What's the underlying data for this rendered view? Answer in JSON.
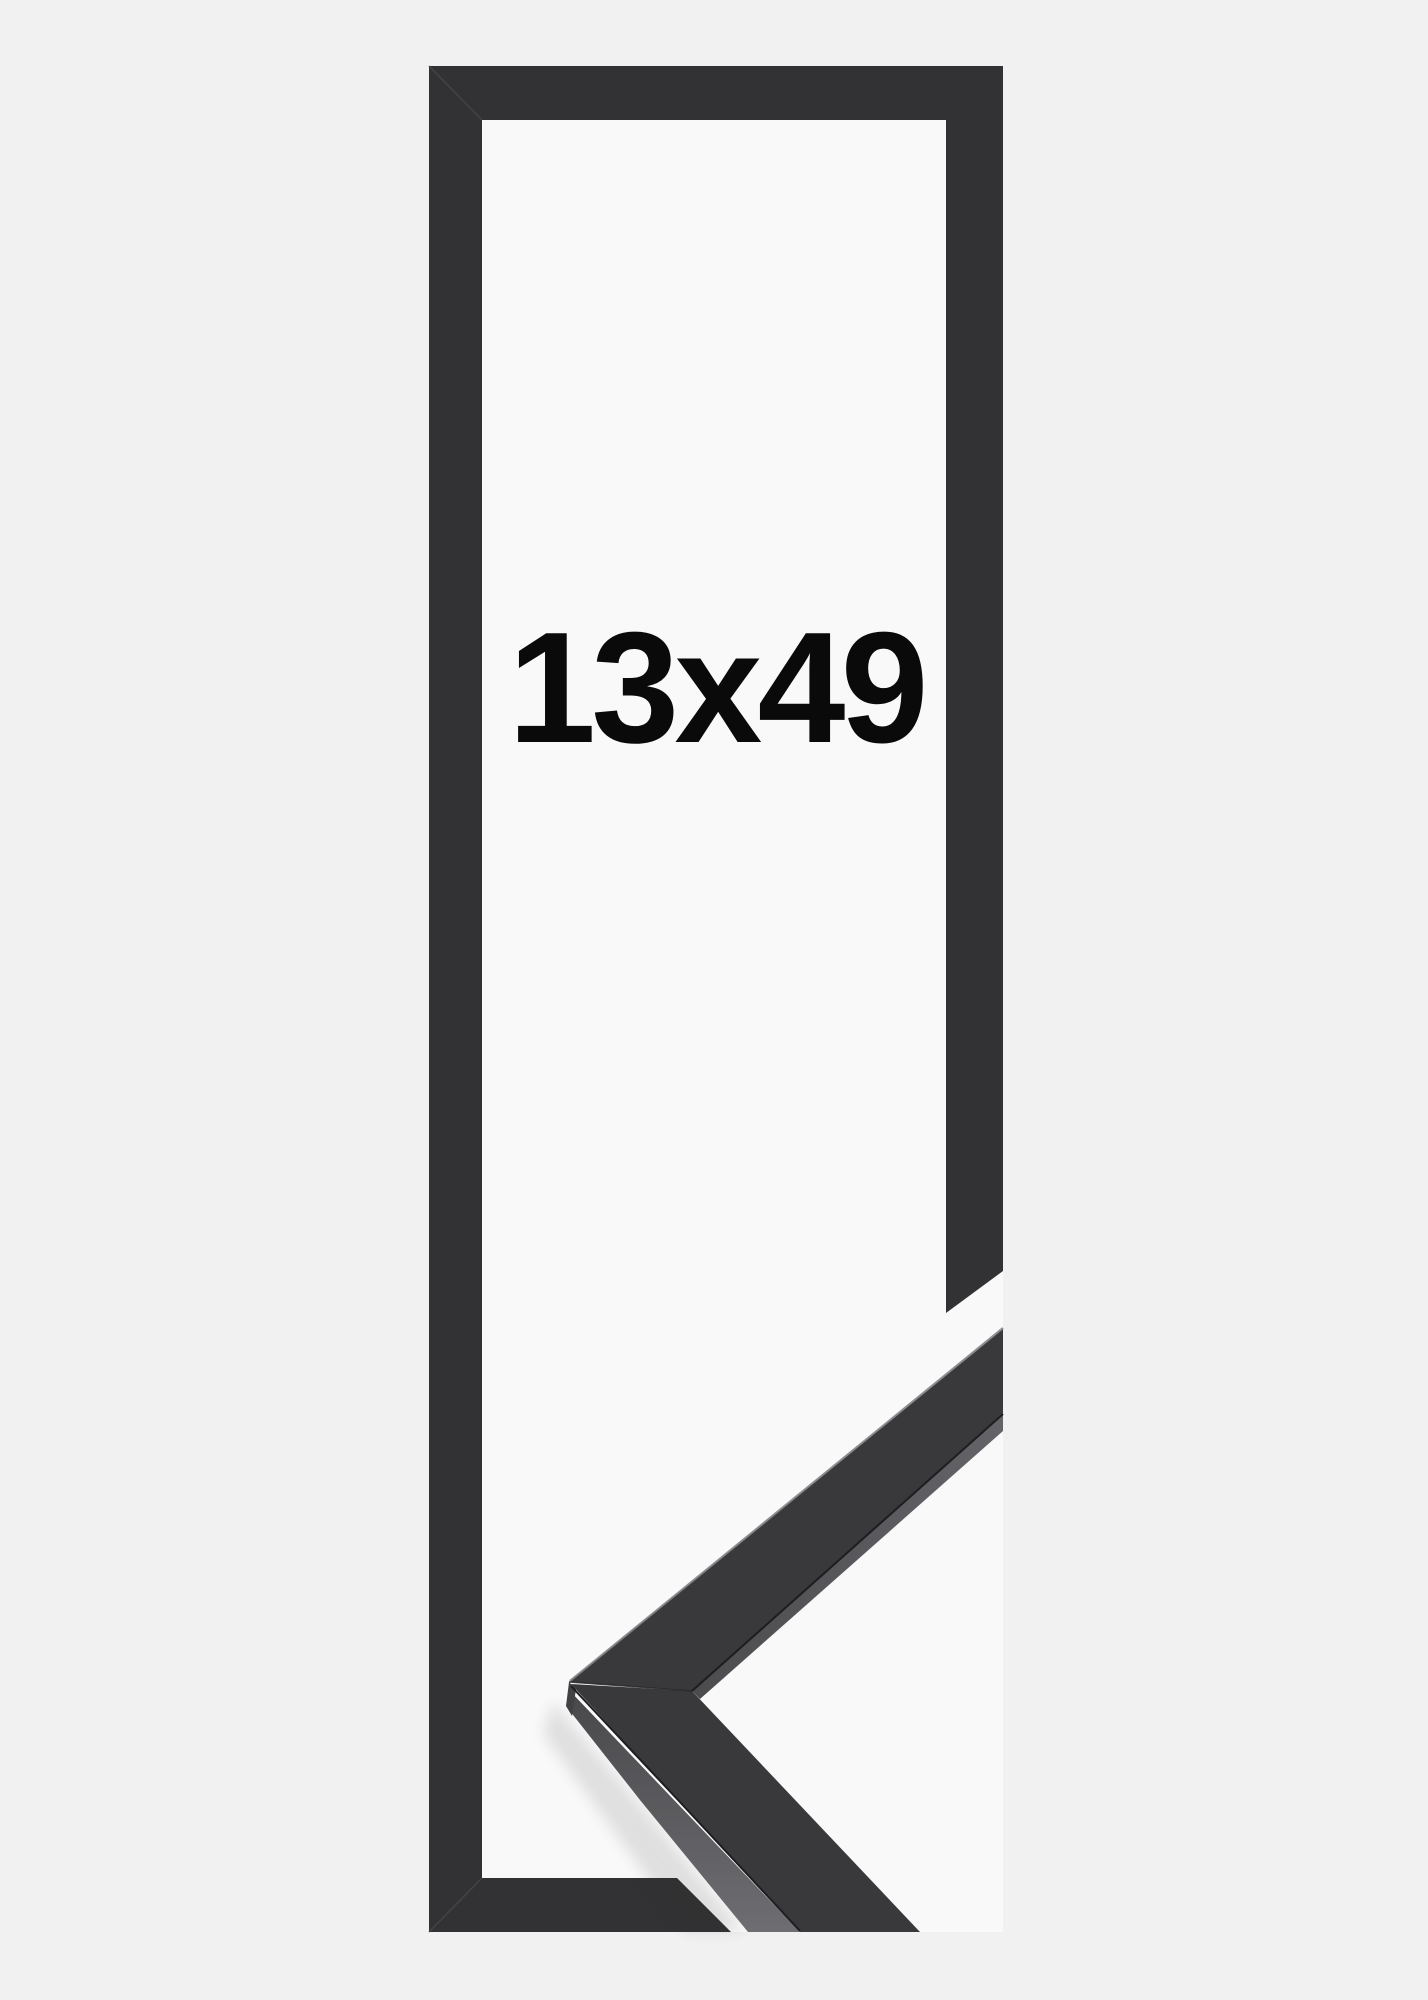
{
  "product_image": {
    "size_label": "13x49",
    "alt_description": "Black picture frame shown in tall portrait proportions with a photographed mitred corner sample of the moulding profile at the lower right",
    "colors": {
      "background": "#f1f1f2",
      "panel": "#f9f9fa",
      "frame_bar": "#323234",
      "corner_miter_seam": "#47474a",
      "sample_face_dark": "#39393b",
      "sample_face_side_top": "#48484b",
      "sample_face_side_bottom": "#6e6e72",
      "sample_seam_dark": "#1d1d1f",
      "sample_edge_highlight": "#7c7c80",
      "sample_vertex_facet": "#424245",
      "label_text": "#0a0a0b"
    }
  }
}
